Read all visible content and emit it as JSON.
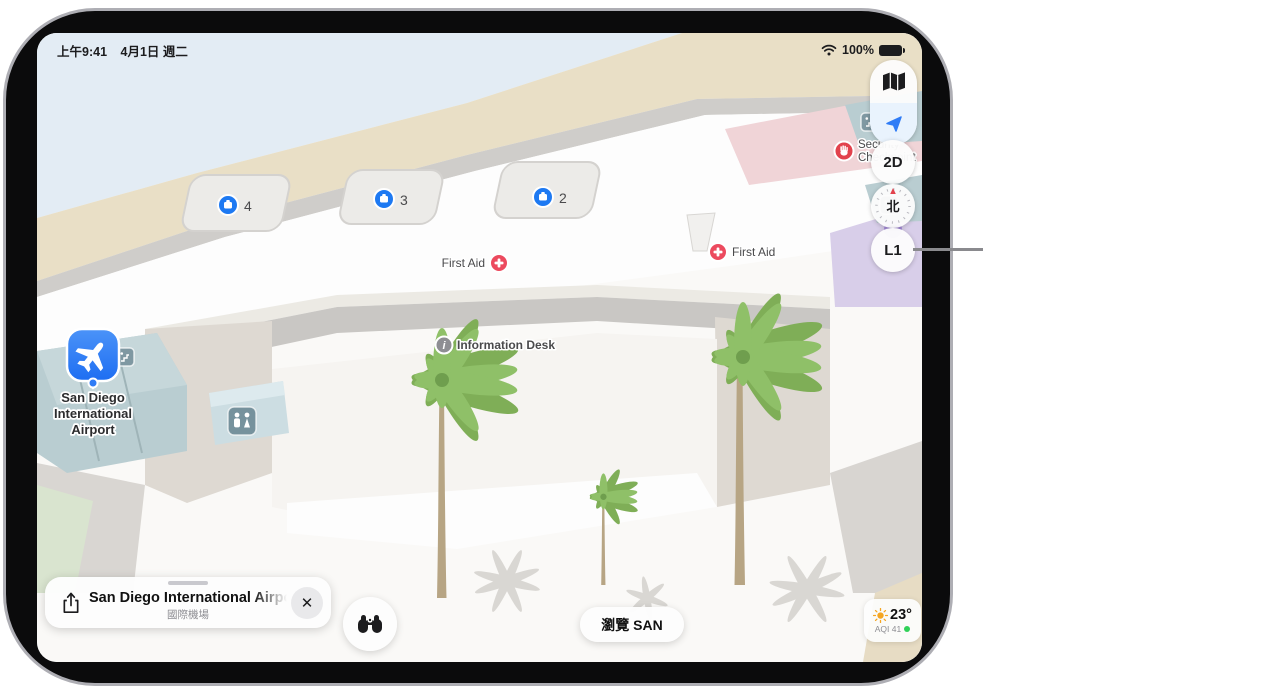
{
  "status_bar": {
    "time": "上午9:41",
    "date": "4月1日 週二",
    "battery": "100%"
  },
  "map_controls": {
    "mode": "2D",
    "compass_north": "北",
    "level": "L1"
  },
  "map": {
    "airport_label": {
      "line1": "San Diego",
      "line2": "International",
      "line3": "Airport"
    },
    "carousel_4": "4",
    "carousel_3": "3",
    "carousel_2": "2",
    "first_aid_left": "First Aid",
    "first_aid_right": "First Aid",
    "security_checkpoint": {
      "line1": "Security",
      "line2": "Checkpoint"
    },
    "information_desk": "Information Desk"
  },
  "place_card": {
    "title": "San Diego International Airport",
    "subtitle": "國際機場"
  },
  "buttons": {
    "browse": "瀏覽 SAN"
  },
  "weather": {
    "temperature": "23°",
    "aqi": "AQI 41"
  },
  "colors": {
    "marker_blue": "#2f7cf6",
    "first_aid_pink": "#ec4a5e",
    "security_red": "#e2424d",
    "aqi_green": "#30d158",
    "sun_yellow": "#f5a623"
  }
}
